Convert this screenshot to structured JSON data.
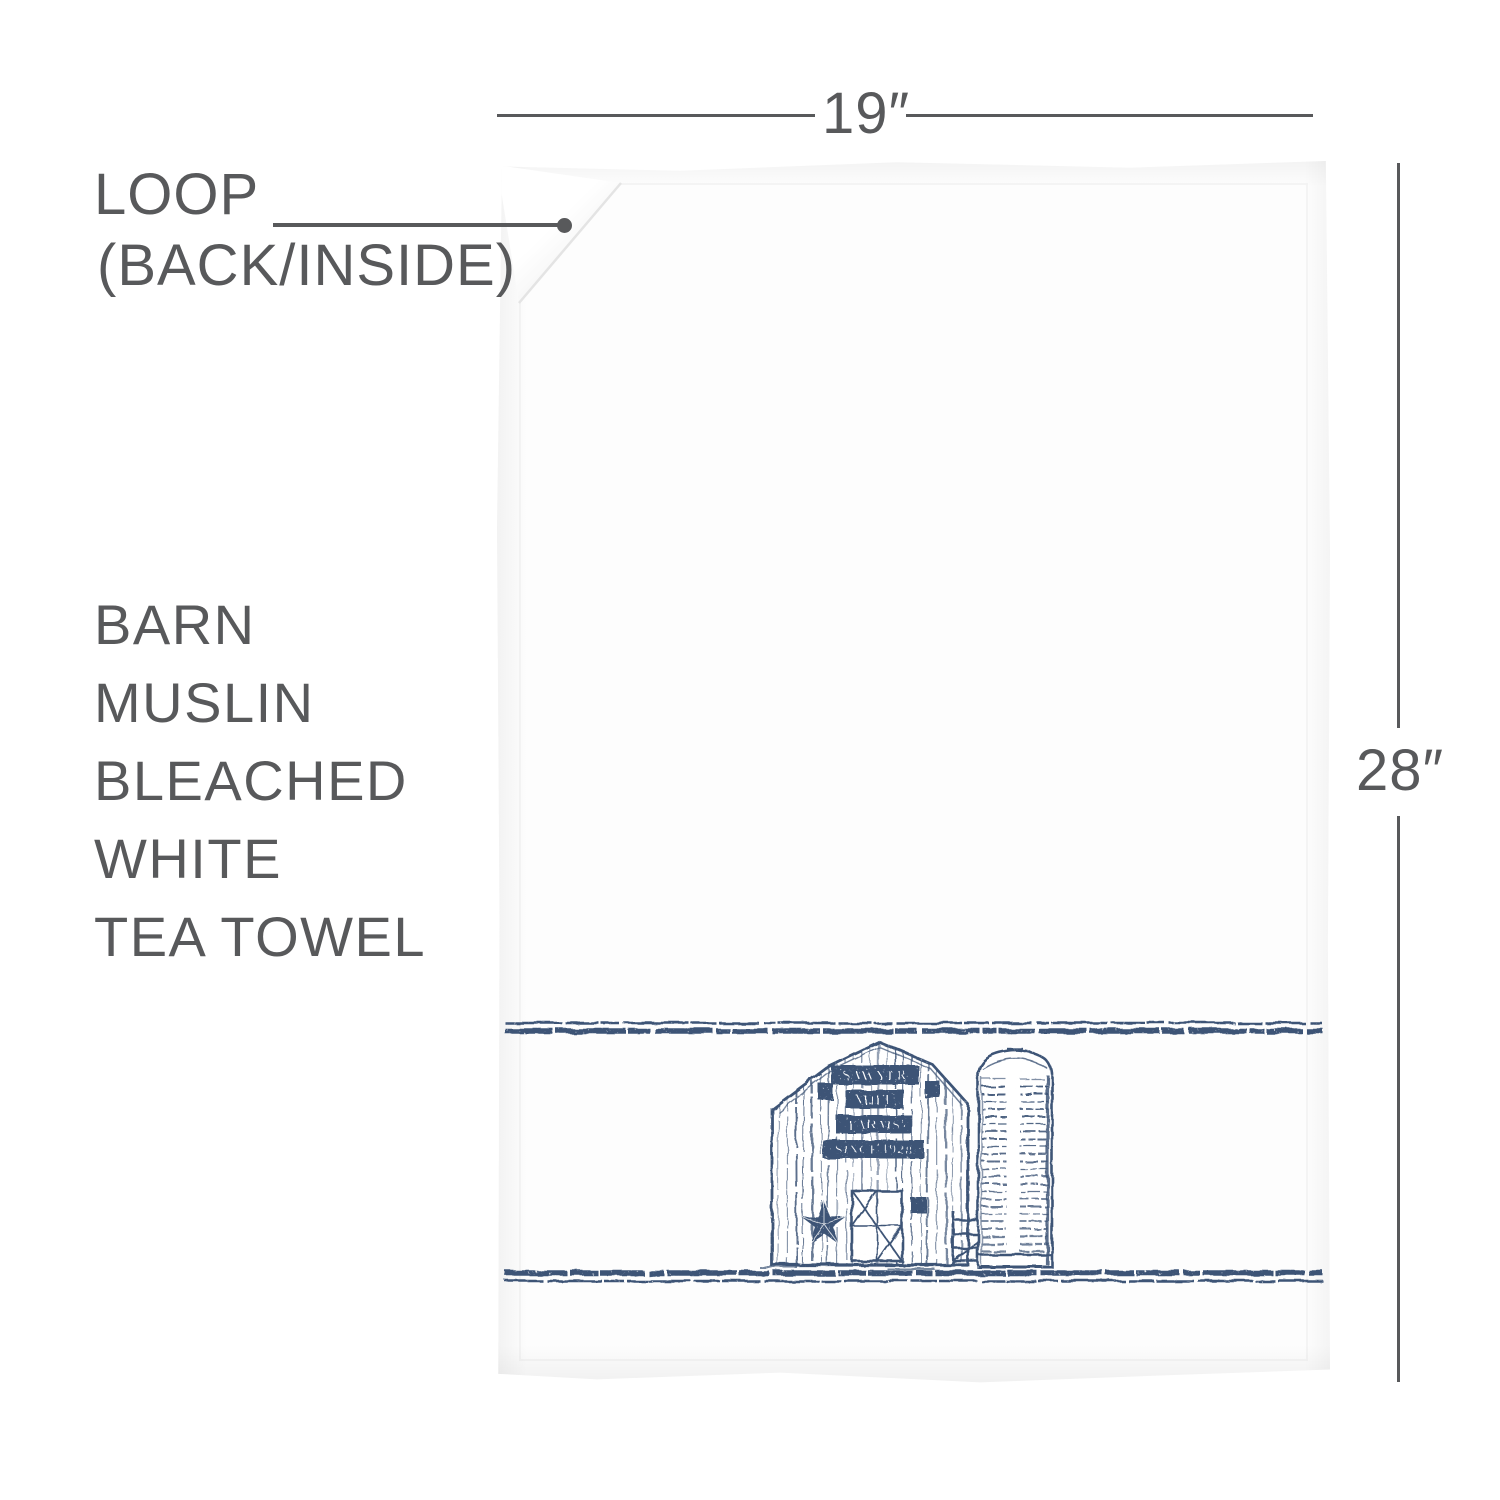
{
  "colors": {
    "annotation_gray": "#58595b",
    "print_navy": "#3d5476",
    "towel_white": "#fdfdfd"
  },
  "annotations": {
    "width_label": "19″",
    "height_label": "28″",
    "loop_callout": [
      "LOOP",
      "(BACK/INSIDE)"
    ],
    "product_title": [
      "BARN",
      "MUSLIN",
      "BLEACHED",
      "WHITE",
      "TEA TOWEL"
    ]
  },
  "towel_print": {
    "barn_sign": [
      "SAWYER",
      "MILL",
      "FARMS",
      "SINCE 1928"
    ]
  }
}
